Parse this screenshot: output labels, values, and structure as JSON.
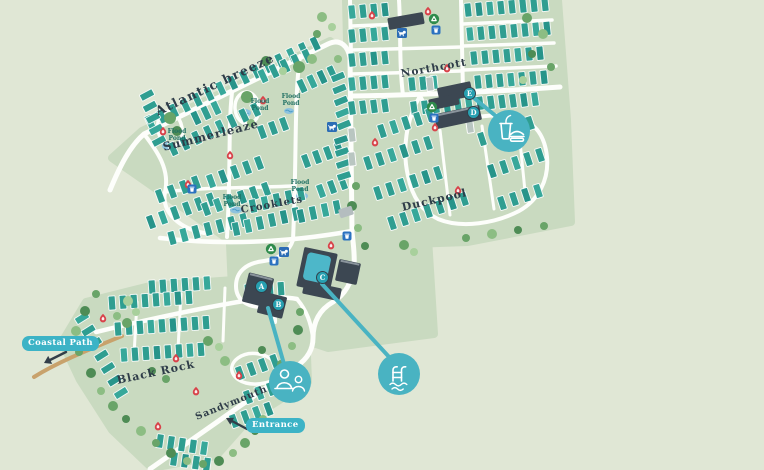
{
  "map": {
    "areas": [
      "Atlantic breeze",
      "Summerleaze",
      "Crooklets",
      "Northcott",
      "Duckpool",
      "Black Rock",
      "Sandymouth"
    ],
    "pond_label": "Flood Pond",
    "badges": {
      "coastal_path": "Coastal Path",
      "entrance": "Entrance"
    },
    "building_markers": [
      "A",
      "B",
      "C",
      "D",
      "E"
    ],
    "poi": [
      {
        "id": "reception",
        "icon": "reception-people-icon"
      },
      {
        "id": "swimming-pool",
        "icon": "swimming-pool-icon"
      },
      {
        "id": "food-drink",
        "icon": "food-drink-icon"
      }
    ],
    "amenity_icons": [
      "fire-point-icon",
      "recycling-icon",
      "waste-bin-icon",
      "dog-walk-icon"
    ],
    "colors": {
      "background": "#e0e7d5",
      "area_green": "#c9dac0",
      "road_white": "#fdfefb",
      "unit_teal": "#2f9e91",
      "unit_pale": "#b9c6c1",
      "building_dark": "#3c4752",
      "pool_teal": "#4db7c9",
      "accent_teal": "#49b3c2",
      "badge_teal": "#3cb3c6",
      "marker_teal": "#27a0b1",
      "path_tan": "#c8a26c",
      "fire_red": "#d8434a",
      "recycle_green": "#2f8b4c",
      "bin_blue": "#2b72c0",
      "dog_blue": "#2b6cb5",
      "pond_blue": "#8ec3de",
      "label_dark": "#2e3c48"
    }
  }
}
